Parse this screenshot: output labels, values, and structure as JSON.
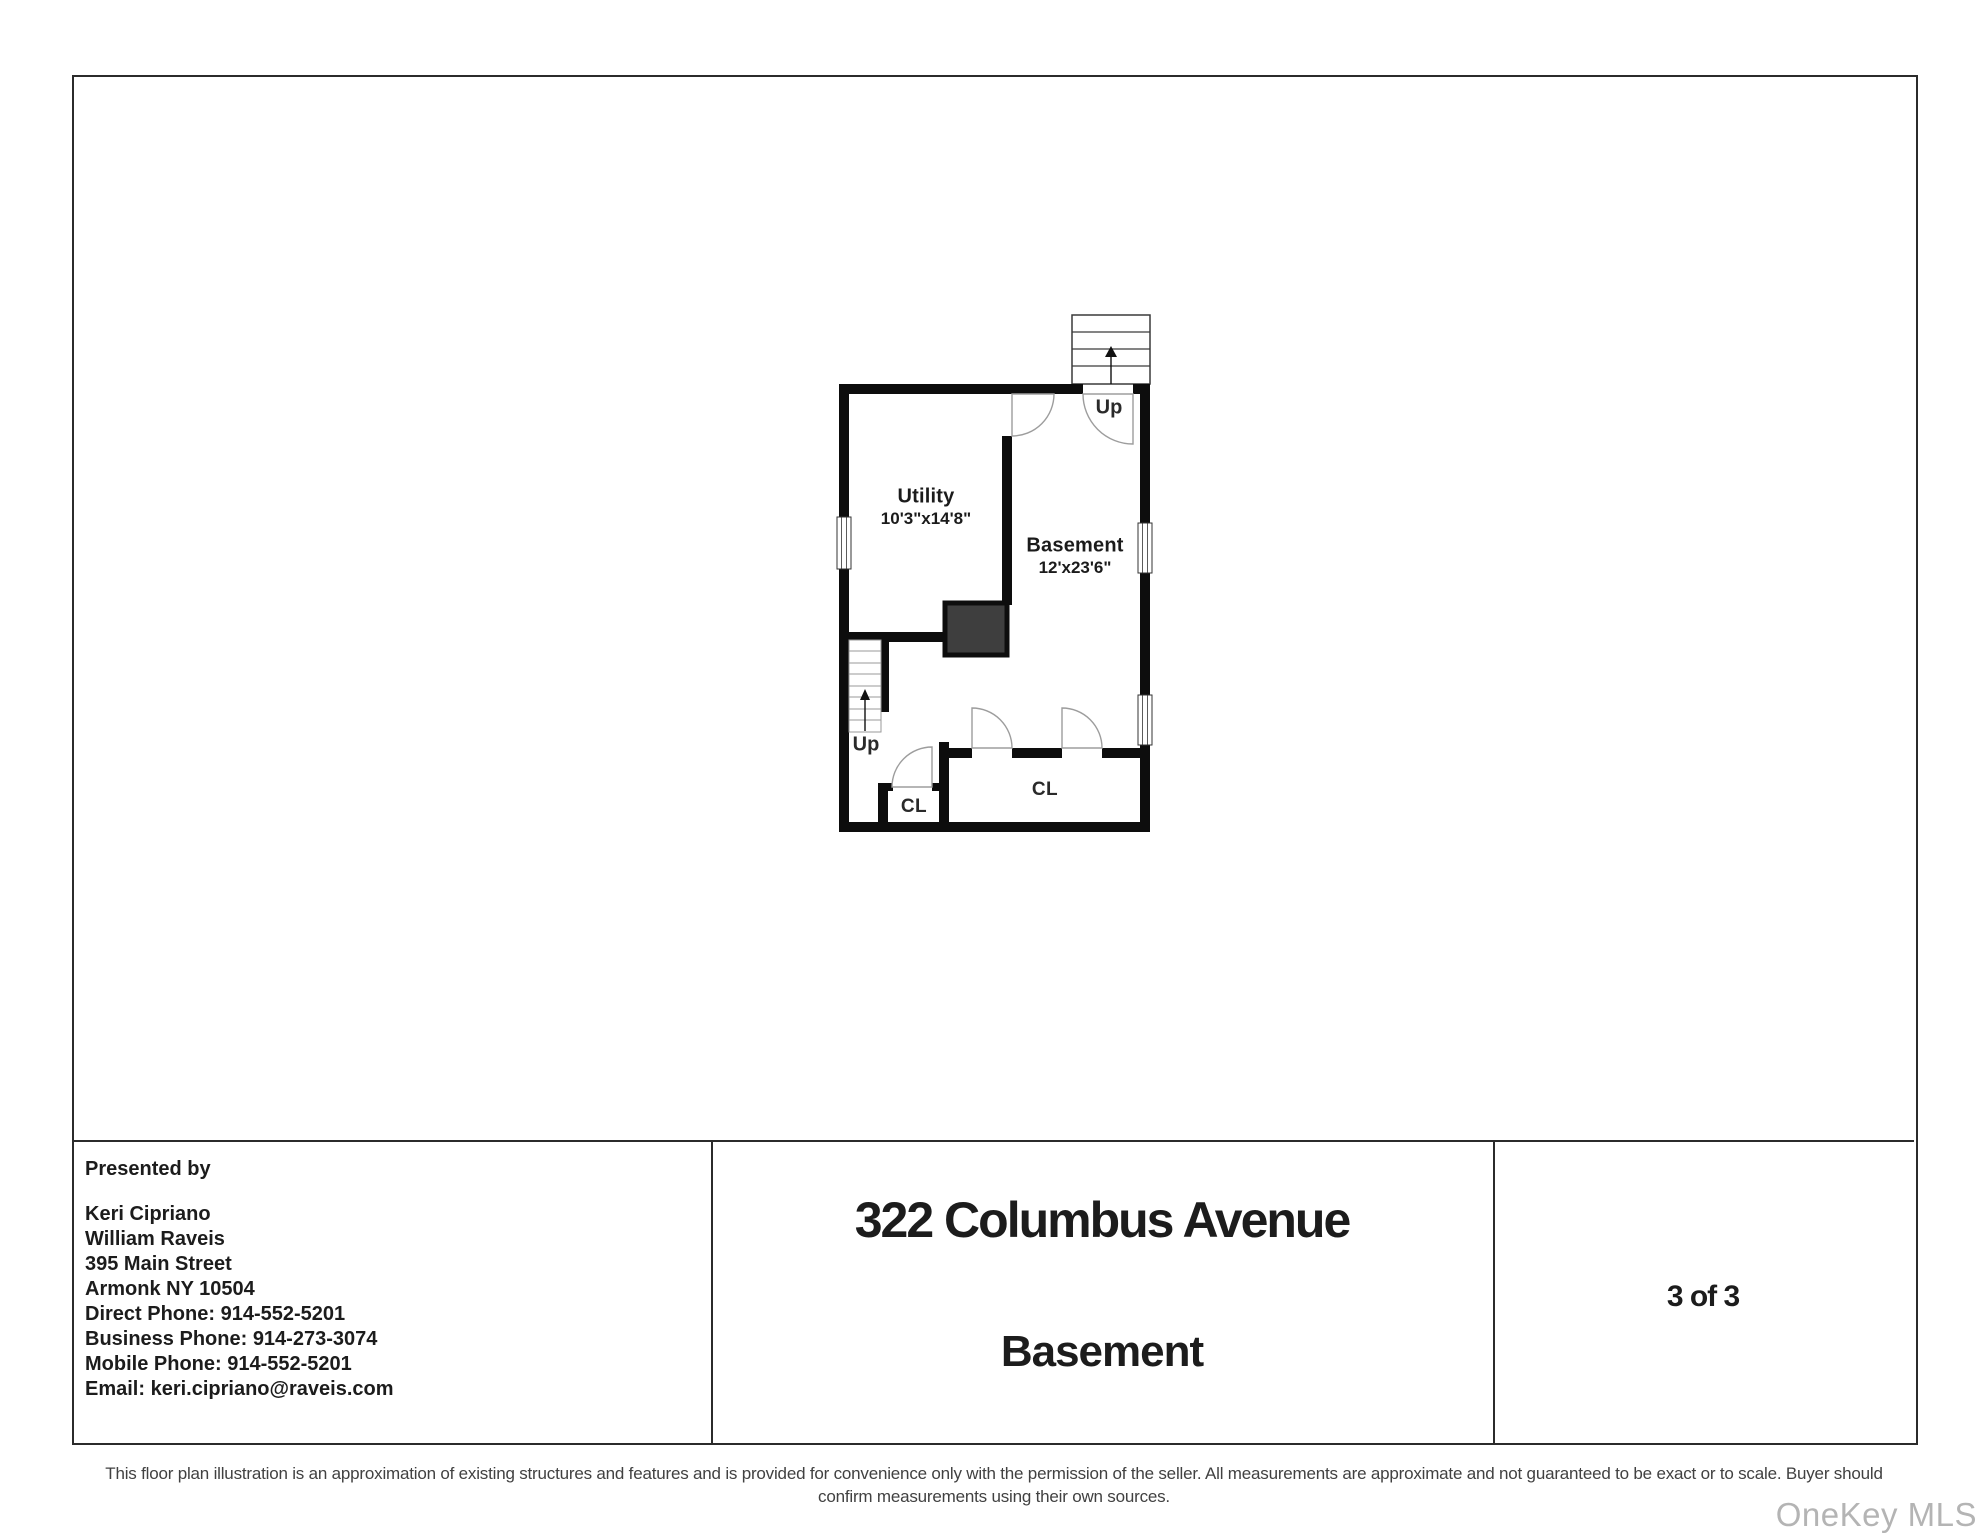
{
  "plan": {
    "rooms": [
      {
        "name": "Utility",
        "dims": "10'3\"x14'8\""
      },
      {
        "name": "Basement",
        "dims": "12'x23'6\""
      }
    ],
    "stairs_up_top": "Up",
    "stairs_up_bottom": "Up",
    "closet_small": "CL",
    "closet_large": "CL",
    "wall_color": "#0d0d0d",
    "furnace_color": "#3e3e3e"
  },
  "footer": {
    "presented_by": "Presented by",
    "agent_lines": [
      "Keri Cipriano",
      "William Raveis",
      "395 Main Street",
      "Armonk NY 10504",
      "Direct Phone: 914-552-5201",
      "Business Phone: 914-273-3074",
      "Mobile Phone: 914-552-5201",
      "Email: keri.cipriano@raveis.com"
    ],
    "address": "322 Columbus Avenue",
    "floor_name": "Basement",
    "page_indicator": "3 of 3"
  },
  "disclaimer": {
    "line1": "This floor plan illustration is an approximation of existing structures and features and is provided for convenience only with the permission of the seller. All measurements are approximate and not guaranteed to be exact or to scale. Buyer should",
    "line2": "confirm measurements using their own sources."
  },
  "watermark": "OneKey MLS"
}
